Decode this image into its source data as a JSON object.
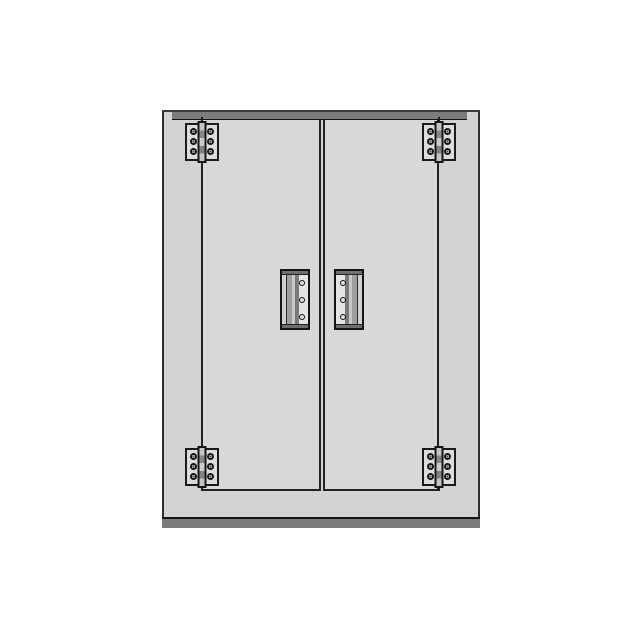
{
  "diagram": {
    "description": "Front view diagram of a two-door cabinet with four surface-mounted butt hinges and two vertical bar handles",
    "parts": {
      "cabinet_label": "cabinet body",
      "top_panel_label": "top panel edge",
      "bottom_panel_label": "bottom kick panel",
      "door_count": 2,
      "hinge_count": 4,
      "hinge_type": "butt-hinge",
      "hinge_screw_holes_each": 6,
      "handle_count": 2,
      "handle_type": "vertical-bar-pull",
      "handle_screw_holes_each": 3
    },
    "colors": {
      "background": "#ffffff",
      "cabinet_fill": "#d3d3d3",
      "door_fill": "#d8d8d8",
      "panel_band": "#7c7c7c",
      "outline": "#1a1a1a",
      "hinge_fill": "#dcdcdc",
      "handle_field": "#e4e4e4"
    }
  }
}
